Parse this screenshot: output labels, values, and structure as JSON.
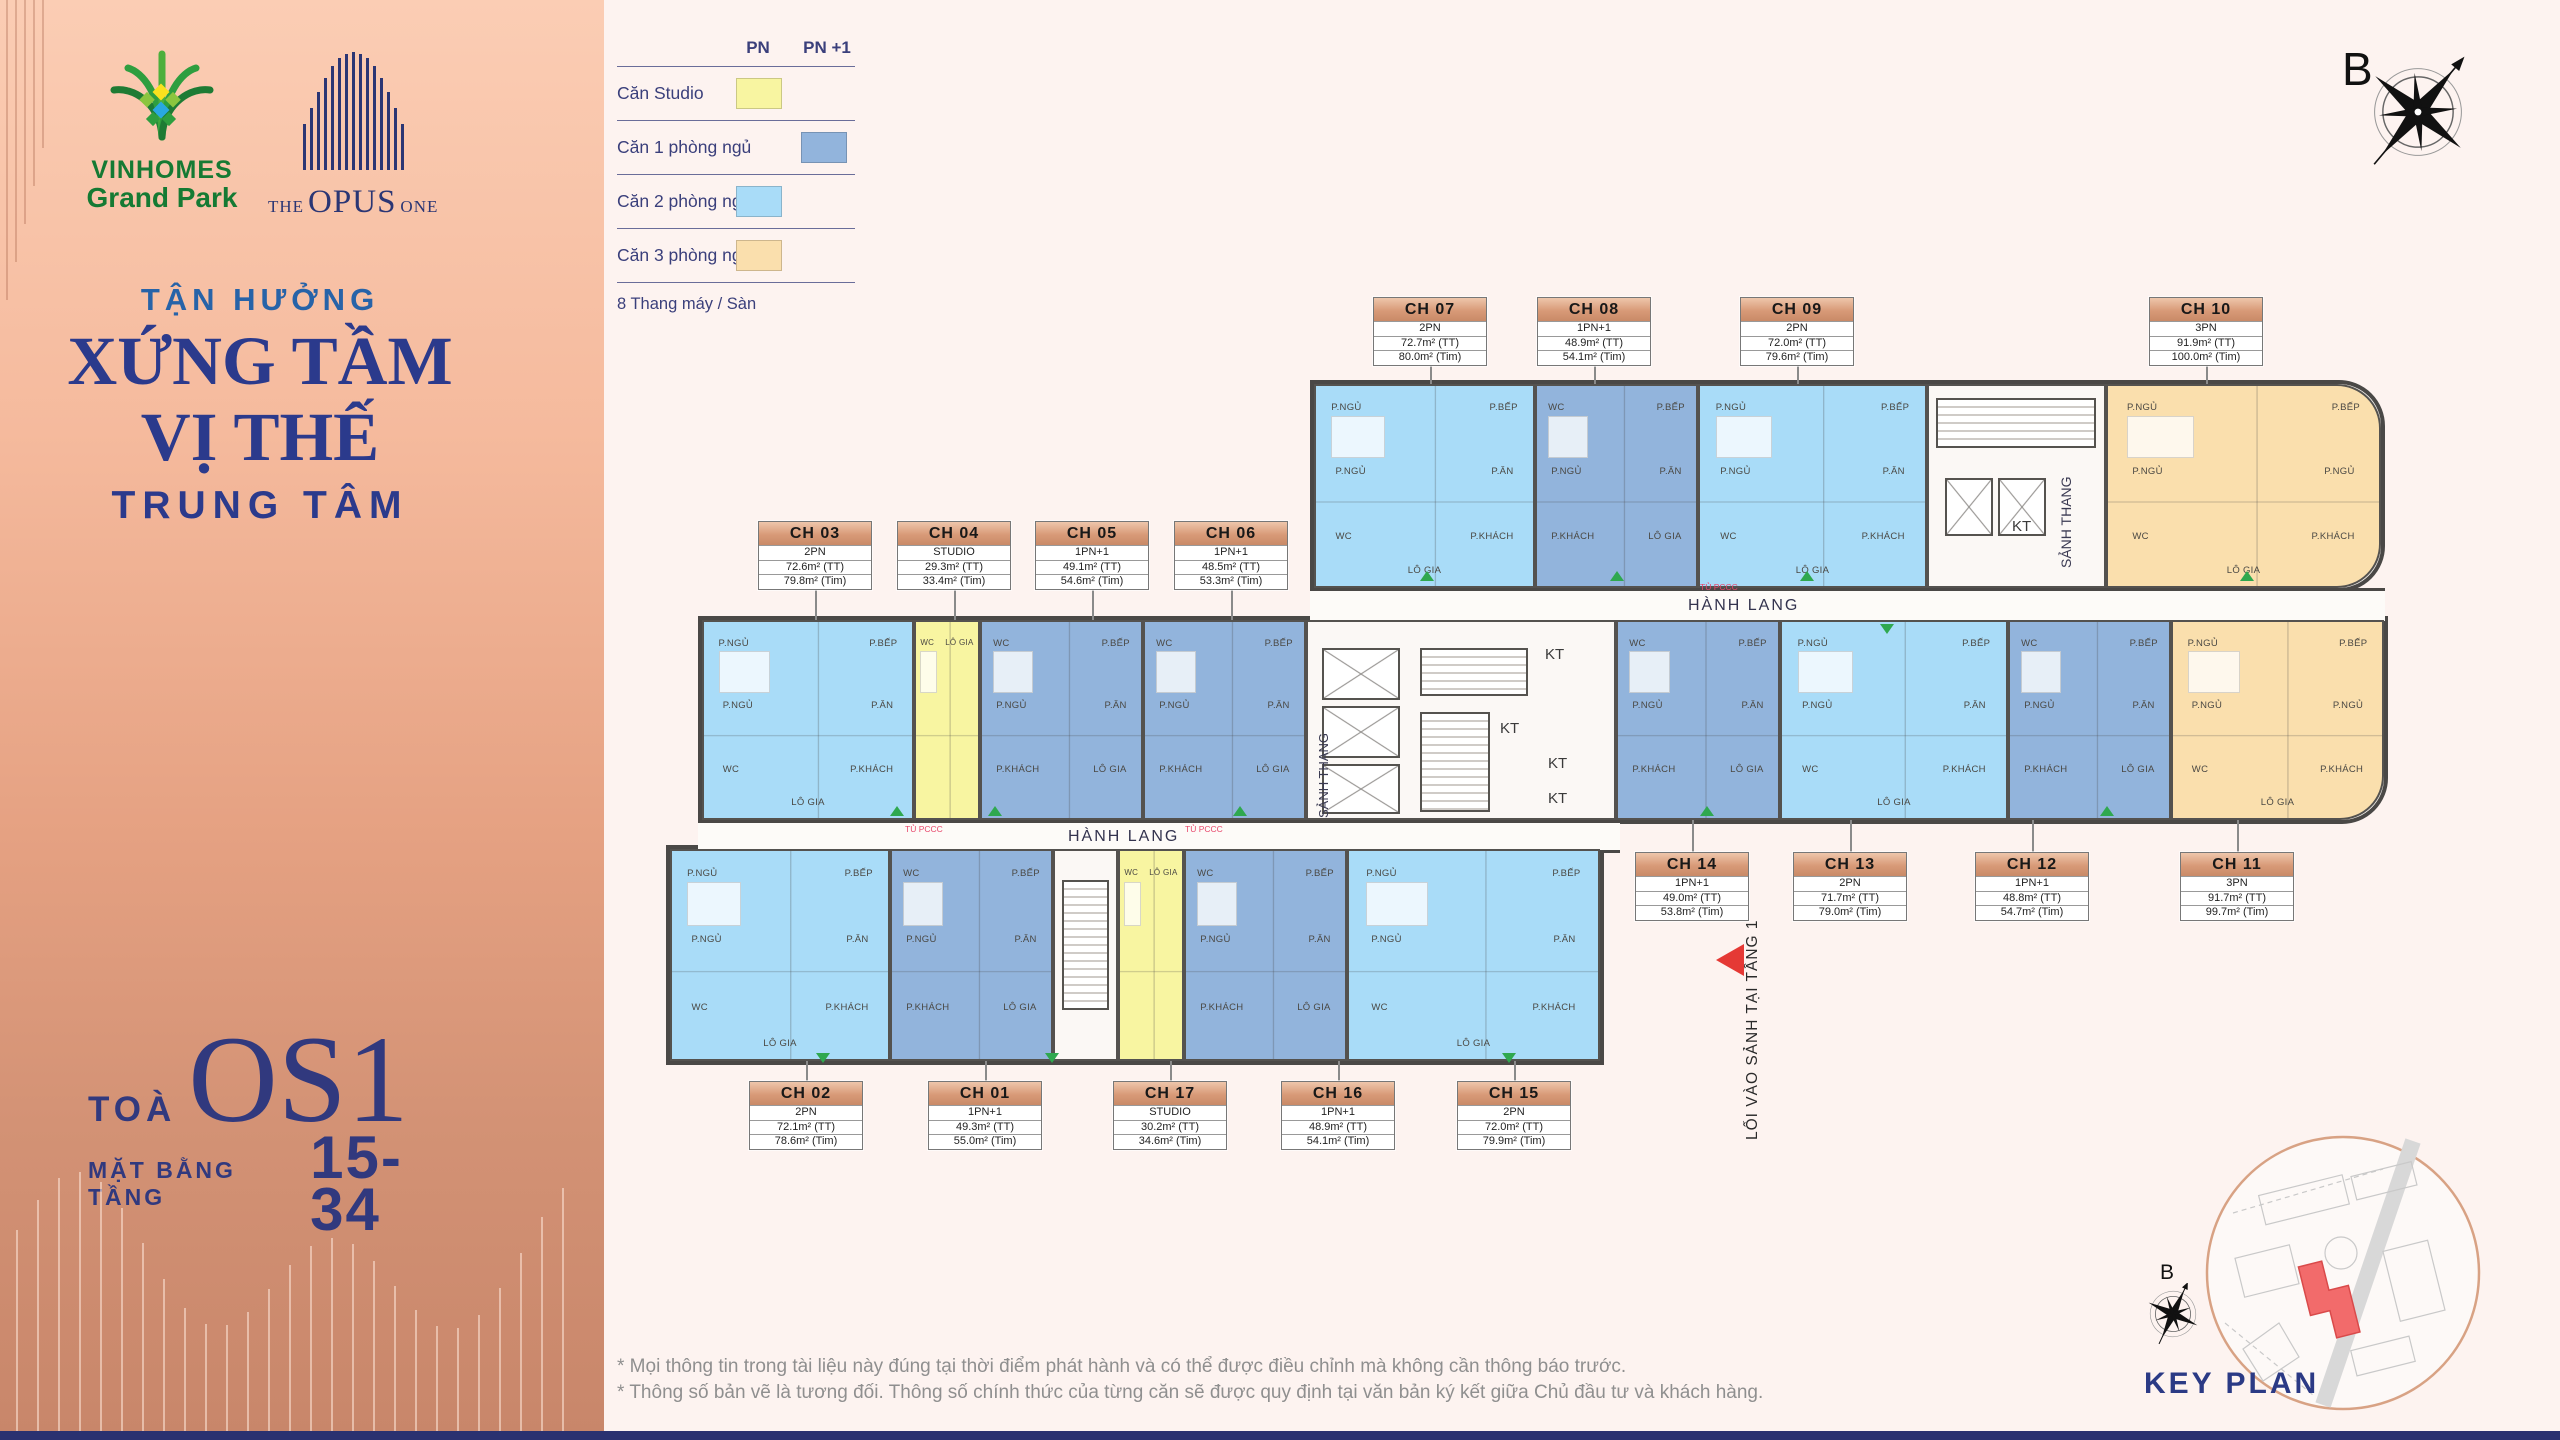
{
  "branding": {
    "vinhomes_line1": "VINHOMES",
    "vinhomes_line2": "Grand Park",
    "opus_the": "THE",
    "opus_main": "OPUS",
    "opus_one": "ONE"
  },
  "hero": {
    "line1": "TẬN HƯỞNG",
    "line2": "XỨNG TẦM",
    "line3": "VỊ THẾ",
    "line4": "TRUNG TÂM"
  },
  "tower": {
    "prefix": "TOÀ",
    "name": "OS1",
    "floor_label": "MẶT BẰNG TẦNG",
    "floor_range": "15-34"
  },
  "legend": {
    "col_pn": "PN",
    "col_pn1": "PN +1",
    "rows": [
      {
        "label": "Căn Studio",
        "column": "PN",
        "color_key": "studio"
      },
      {
        "label": "Căn 1 phòng ngủ",
        "column": "PN +1",
        "color_key": "pn1"
      },
      {
        "label": "Căn 2 phòng ngủ",
        "column": "PN",
        "color_key": "pn2"
      },
      {
        "label": "Căn 3 phòng ngủ",
        "column": "PN",
        "color_key": "pn3"
      }
    ],
    "footer": "8 Thang máy / Sàn"
  },
  "compass": {
    "letter": "B"
  },
  "plan": {
    "corridor_label": "HÀNH LANG",
    "lobby_label": "SẢNH THANG",
    "kt_label": "KT",
    "fire_label": "TỦ PCCC",
    "entrance_label": "LỐI VÀO SẢNH TẠI TẦNG 1",
    "room_sets": {
      "studio": [
        "WC",
        "LÔ GIA"
      ],
      "pn1": [
        "WC",
        "P.BẾP",
        "P.NGỦ",
        "P.ĂN",
        "P.KHÁCH",
        "LÔ GIA"
      ],
      "pn2": [
        "P.NGỦ",
        "P.BẾP",
        "P.NGỦ",
        "P.ĂN",
        "WC",
        "P.KHÁCH",
        "LÔ GIA"
      ],
      "pn3": [
        "P.NGỦ",
        "P.BẾP",
        "P.NGỦ",
        "P.NGỦ",
        "WC",
        "P.KHÁCH",
        "LÔ GIA"
      ]
    },
    "units": [
      {
        "id": "ch01",
        "name": "CH 01",
        "type": "1PN+1",
        "area_tt": "49.3m² (TT)",
        "area_tim": "55.0m² (Tim)",
        "category": "pn1"
      },
      {
        "id": "ch02",
        "name": "CH 02",
        "type": "2PN",
        "area_tt": "72.1m² (TT)",
        "area_tim": "78.6m² (Tim)",
        "category": "pn2"
      },
      {
        "id": "ch03",
        "name": "CH 03",
        "type": "2PN",
        "area_tt": "72.6m² (TT)",
        "area_tim": "79.8m² (Tim)",
        "category": "pn2"
      },
      {
        "id": "ch04",
        "name": "CH 04",
        "type": "STUDIO",
        "area_tt": "29.3m² (TT)",
        "area_tim": "33.4m² (Tim)",
        "category": "studio"
      },
      {
        "id": "ch05",
        "name": "CH 05",
        "type": "1PN+1",
        "area_tt": "49.1m² (TT)",
        "area_tim": "54.6m² (Tim)",
        "category": "pn1"
      },
      {
        "id": "ch06",
        "name": "CH 06",
        "type": "1PN+1",
        "area_tt": "48.5m² (TT)",
        "area_tim": "53.3m² (Tim)",
        "category": "pn1"
      },
      {
        "id": "ch07",
        "name": "CH 07",
        "type": "2PN",
        "area_tt": "72.7m² (TT)",
        "area_tim": "80.0m² (Tim)",
        "category": "pn2"
      },
      {
        "id": "ch08",
        "name": "CH 08",
        "type": "1PN+1",
        "area_tt": "48.9m² (TT)",
        "area_tim": "54.1m² (Tim)",
        "category": "pn1"
      },
      {
        "id": "ch09",
        "name": "CH 09",
        "type": "2PN",
        "area_tt": "72.0m² (TT)",
        "area_tim": "79.6m² (Tim)",
        "category": "pn2"
      },
      {
        "id": "ch10",
        "name": "CH 10",
        "type": "3PN",
        "area_tt": "91.9m² (TT)",
        "area_tim": "100.0m² (Tim)",
        "category": "pn3"
      },
      {
        "id": "ch11",
        "name": "CH 11",
        "type": "3PN",
        "area_tt": "91.7m² (TT)",
        "area_tim": "99.7m² (Tim)",
        "category": "pn3"
      },
      {
        "id": "ch12",
        "name": "CH 12",
        "type": "1PN+1",
        "area_tt": "48.8m² (TT)",
        "area_tim": "54.7m² (Tim)",
        "category": "pn1"
      },
      {
        "id": "ch13",
        "name": "CH 13",
        "type": "2PN",
        "area_tt": "71.7m² (TT)",
        "area_tim": "79.0m² (Tim)",
        "category": "pn2"
      },
      {
        "id": "ch14",
        "name": "CH 14",
        "type": "1PN+1",
        "area_tt": "49.0m² (TT)",
        "area_tim": "53.8m² (Tim)",
        "category": "pn1"
      },
      {
        "id": "ch15",
        "name": "CH 15",
        "type": "2PN",
        "area_tt": "72.0m² (TT)",
        "area_tim": "79.9m² (Tim)",
        "category": "pn2"
      },
      {
        "id": "ch16",
        "name": "CH 16",
        "type": "1PN+1",
        "area_tt": "48.9m² (TT)",
        "area_tim": "54.1m² (Tim)",
        "category": "pn1"
      },
      {
        "id": "ch17",
        "name": "CH 17",
        "type": "STUDIO",
        "area_tt": "30.2m² (TT)",
        "area_tim": "34.6m² (Tim)",
        "category": "studio"
      }
    ]
  },
  "key_plan": {
    "title": "KEY PLAN",
    "compass_letter": "B"
  },
  "disclaimer": {
    "line1": "* Mọi thông tin trong tài liệu này đúng tại thời điểm phát hành và có thể được điều chỉnh mà không cần thông báo trước.",
    "line2": "* Thông số bản vẽ là tương đối. Thông số chính thức của từng căn sẽ được quy định tại văn bản ký kết giữa Chủ đầu tư và khách hàng."
  },
  "colors": {
    "studio": "#F8F5A1",
    "pn1": "#92B4DC",
    "pn2": "#A9DCF8",
    "pn3": "#FADFAD",
    "navy": "#2B3A85",
    "copper_light": "#EEC6AB",
    "copper_dark": "#C98A67",
    "red": "#E53935",
    "green_marker": "#2FA84F",
    "key_red": "#F26B6B"
  }
}
